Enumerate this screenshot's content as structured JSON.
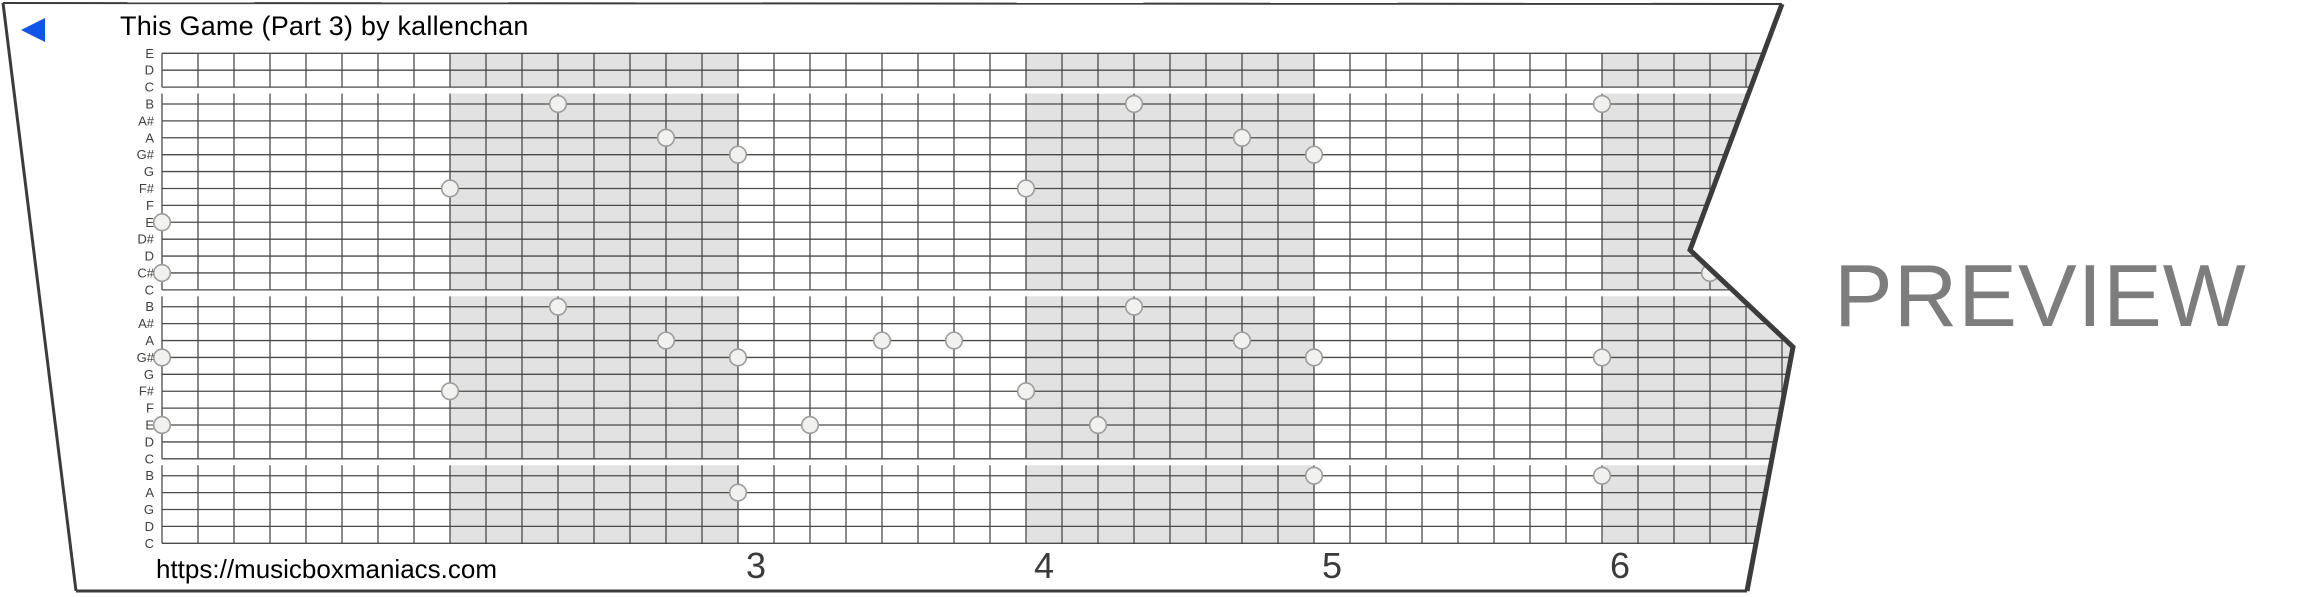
{
  "title": "This Game (Part 3) by kallenchan",
  "footer_url": "https://musicboxmaniacs.com",
  "watermark": "PREVIEW",
  "icons": {
    "play_marker": "left-pointing-triangle"
  },
  "colors": {
    "play_triangle_blue": "#1253e9",
    "shaded_measure_gray": "#e2e2e2",
    "grid_line": "#4a4a4a",
    "paper_edge": "#3c3c3c",
    "hole_fill": "#f1f1ef",
    "hole_stroke": "#9c9c9c",
    "watermark_gray": "#7d7d7d",
    "label_gray": "#3f3f3f",
    "number_gray": "#3a3a3a"
  },
  "chart_data": {
    "type": "piano-roll-strip",
    "title": "This Game (Part 3) by kallenchan",
    "row_labels_top_to_bottom": [
      "E",
      "D",
      "C",
      "B",
      "A#",
      "A",
      "G#",
      "G",
      "F#",
      "F",
      "E",
      "D#",
      "D",
      "C#",
      "C",
      "B",
      "A#",
      "A",
      "G#",
      "G",
      "F#",
      "F",
      "E",
      "D",
      "C",
      "B",
      "A",
      "G",
      "D",
      "C"
    ],
    "rows": 30,
    "cells_per_measure": 8,
    "visible_cell_columns": 45,
    "shaded_measure_start_cols": [
      8,
      24,
      40
    ],
    "octave_break_below_rows": [
      3,
      15,
      25
    ],
    "measure_numbers": [
      {
        "label": "3",
        "col": 16
      },
      {
        "label": "4",
        "col": 24
      },
      {
        "label": "5",
        "col": 32
      },
      {
        "label": "6",
        "col": 40
      }
    ],
    "holes": [
      {
        "col": 0,
        "row": 11,
        "note": "E"
      },
      {
        "col": 0,
        "row": 14,
        "note": "C#"
      },
      {
        "col": 0,
        "row": 19,
        "note": "G#"
      },
      {
        "col": 0,
        "row": 23,
        "note": "E"
      },
      {
        "col": 8,
        "row": 9,
        "note": "F#"
      },
      {
        "col": 8,
        "row": 21,
        "note": "F#"
      },
      {
        "col": 11,
        "row": 4,
        "note": "B"
      },
      {
        "col": 11,
        "row": 16,
        "note": "B"
      },
      {
        "col": 14,
        "row": 6,
        "note": "A"
      },
      {
        "col": 14,
        "row": 18,
        "note": "A"
      },
      {
        "col": 16,
        "row": 7,
        "note": "G#"
      },
      {
        "col": 16,
        "row": 19,
        "note": "G#"
      },
      {
        "col": 16,
        "row": 27,
        "note": "A"
      },
      {
        "col": 18,
        "row": 23,
        "note": "E"
      },
      {
        "col": 20,
        "row": 18,
        "note": "A"
      },
      {
        "col": 22,
        "row": 18,
        "note": "A"
      },
      {
        "col": 24,
        "row": 9,
        "note": "F#"
      },
      {
        "col": 24,
        "row": 21,
        "note": "F#"
      },
      {
        "col": 26,
        "row": 23,
        "note": "E"
      },
      {
        "col": 27,
        "row": 4,
        "note": "B"
      },
      {
        "col": 27,
        "row": 16,
        "note": "B"
      },
      {
        "col": 30,
        "row": 6,
        "note": "A"
      },
      {
        "col": 30,
        "row": 18,
        "note": "A"
      },
      {
        "col": 32,
        "row": 7,
        "note": "G#"
      },
      {
        "col": 32,
        "row": 19,
        "note": "G#"
      },
      {
        "col": 32,
        "row": 26,
        "note": "B"
      },
      {
        "col": 40,
        "row": 4,
        "note": "B"
      },
      {
        "col": 40,
        "row": 19,
        "note": "G#"
      },
      {
        "col": 40,
        "row": 26,
        "note": "B"
      },
      {
        "col": 43,
        "row": 14,
        "note": "C#"
      }
    ]
  }
}
